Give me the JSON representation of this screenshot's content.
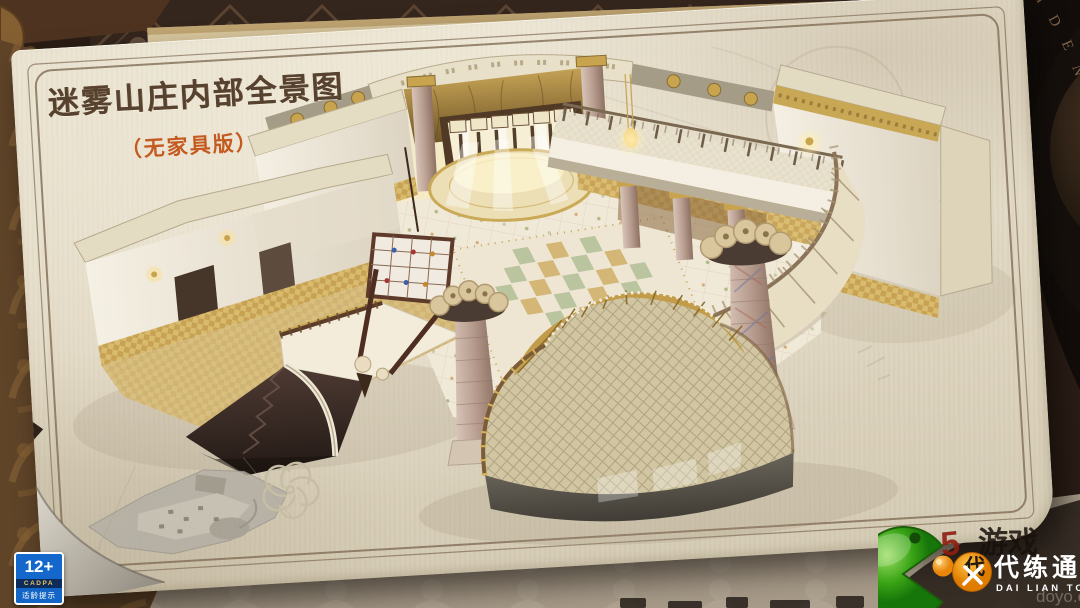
{
  "poster": {
    "title": "迷雾山庄内部全景图",
    "subtitle": "（无家具版）"
  },
  "background": {
    "seal_text": "IDENTITY"
  },
  "age_rating": {
    "age": "12+",
    "org": "CADPA",
    "caption": "适龄提示"
  },
  "watermark": {
    "brand_cn": "代练通",
    "brand_en": "DAI LIAN TONG",
    "badge_char": "代",
    "red_char": "5",
    "shadow_chars": "游戏",
    "site": "doyo.cn"
  },
  "colors": {
    "paper": "#e5ddc9",
    "title_ink": "#57422f",
    "subtitle_accent": "#c45a20",
    "rating_blue": "#1568cb",
    "logo_green": "#3fa81d",
    "logo_orange": "#f2980d",
    "mural_gold": "#b18e44",
    "floor_green": "#b5c29a"
  }
}
